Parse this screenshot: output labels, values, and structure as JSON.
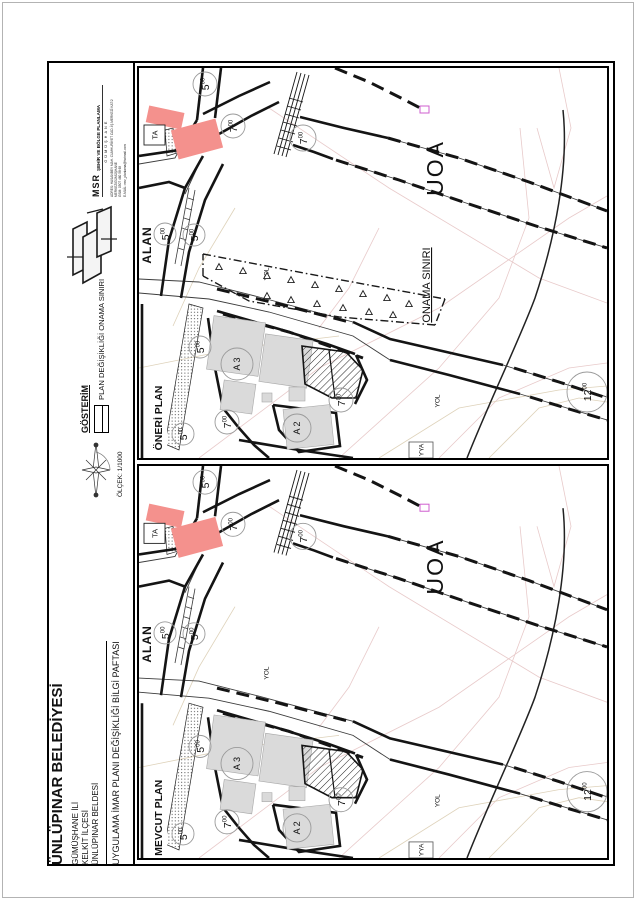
{
  "title_block": {
    "firm": {
      "abbr": "MSR",
      "name": "ŞEHİR VE BÖLGE PLANLAMA",
      "sub": "GÜMÜŞHANE",
      "address": "ADRES: HASANBEY MAH. CUMHURİYET CAD. İŞ MERKEZİ KAT:2 MERKEZ/GÜMÜŞHANE",
      "gsm": "GSM: 0507 460 58 69",
      "email": "E-MAİL: msr_planlama@hotmail.com"
    },
    "legend": {
      "heading": "GÖSTERİM",
      "item_label": "PLAN DEĞİŞİKLİĞİ ONAMA SINIRI"
    },
    "scale_label": "ÖLÇEK: 1/1000",
    "municipality": "ÜNLÜPINAR BELEDİYESİ",
    "province": "GÜMÜŞHANE İLİ",
    "district": "KELKİT İLÇESİ",
    "town": "ÜNLÜPINAR BELDESİ",
    "sheet_title": "UYGULAMA İMAR PLANI DEĞİŞİKLİĞİ BİLGİ PAFTASI"
  },
  "maps": {
    "proposed": {
      "panel_label": "ÖNERİ PLAN",
      "area_label": "ALAN",
      "zone_label": "UOA",
      "approval_boundary_label": "ONAMA SINIRI",
      "ta_label": "TA",
      "a3_label": "A 3",
      "a2_label": "A 2",
      "yol_label_1": "YOL",
      "yol_label_2": "YOL",
      "yya_label": "YYA"
    },
    "existing": {
      "panel_label": "MEVCUT PLAN",
      "area_label": "ALAN",
      "zone_label": "UOA",
      "ta_label": "TA",
      "a3_label": "A 3",
      "a2_label": "A 2",
      "yol_label_1": "YOL",
      "yol_label_2": "YOL",
      "yya_label": "YYA"
    }
  },
  "dims": {
    "w5_main": "5",
    "w5_sup": "00",
    "w7_main": "7",
    "w7_sup": "00",
    "w12_main": "12",
    "w12_sup": "00"
  },
  "colors": {
    "building_red": "#f4918d",
    "building_gray": "#dadada",
    "road_label_magenta": "#c433c4",
    "cadastral_pink": "#e8caca",
    "cadastral_tan": "#ded2ba"
  }
}
